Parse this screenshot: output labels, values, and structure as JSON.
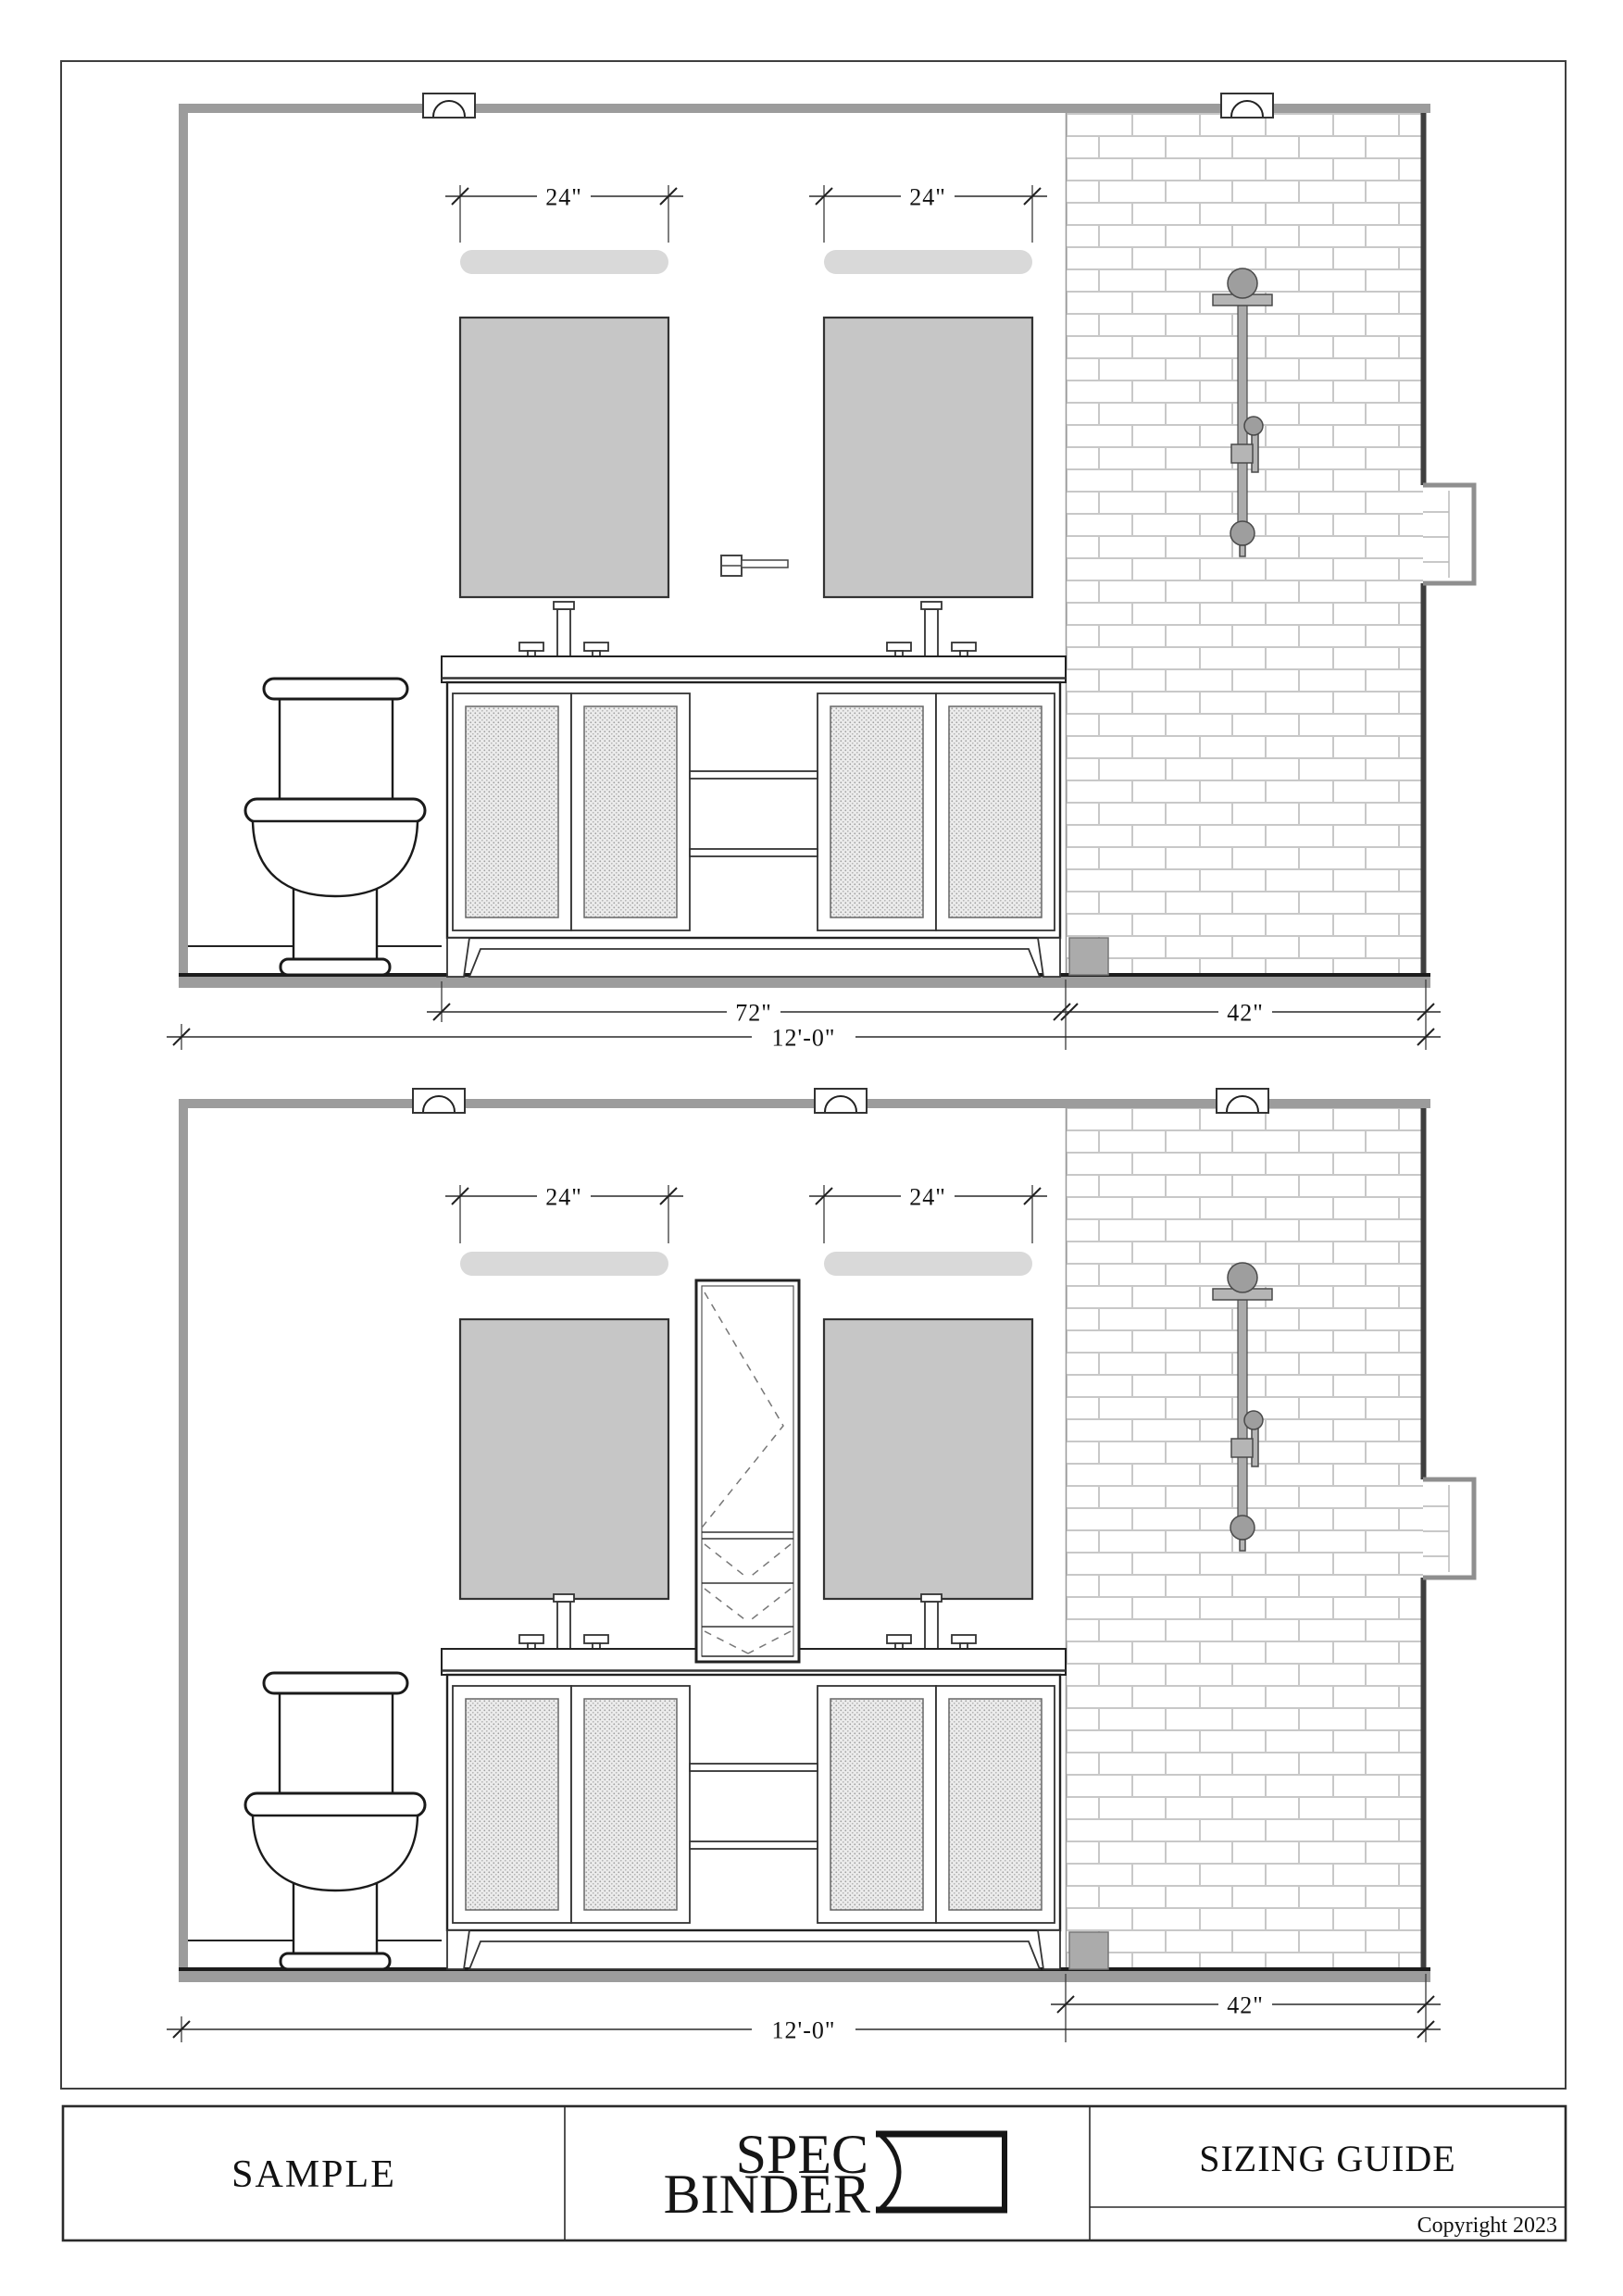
{
  "drawing_top": {
    "dim_mirror_left": "24\"",
    "dim_mirror_right": "24\"",
    "dim_vanity": "72\"",
    "dim_shower": "42\"",
    "dim_total": "12'-0\""
  },
  "drawing_bottom": {
    "dim_mirror_left": "24\"",
    "dim_mirror_right": "24\"",
    "dim_shower": "42\"",
    "dim_total": "12'-0\""
  },
  "footer": {
    "sample": "SAMPLE",
    "logo_line1": "SPEC",
    "logo_line2": "BINDER",
    "sizing": "SIZING GUIDE",
    "copyright": "Copyright 2023"
  },
  "colors": {
    "mirror_fill": "#c6c6c6",
    "lightbar_fill": "#d9d9d9",
    "wall_gray": "#9c9c9c",
    "tile_joint": "#c8c8c8"
  }
}
